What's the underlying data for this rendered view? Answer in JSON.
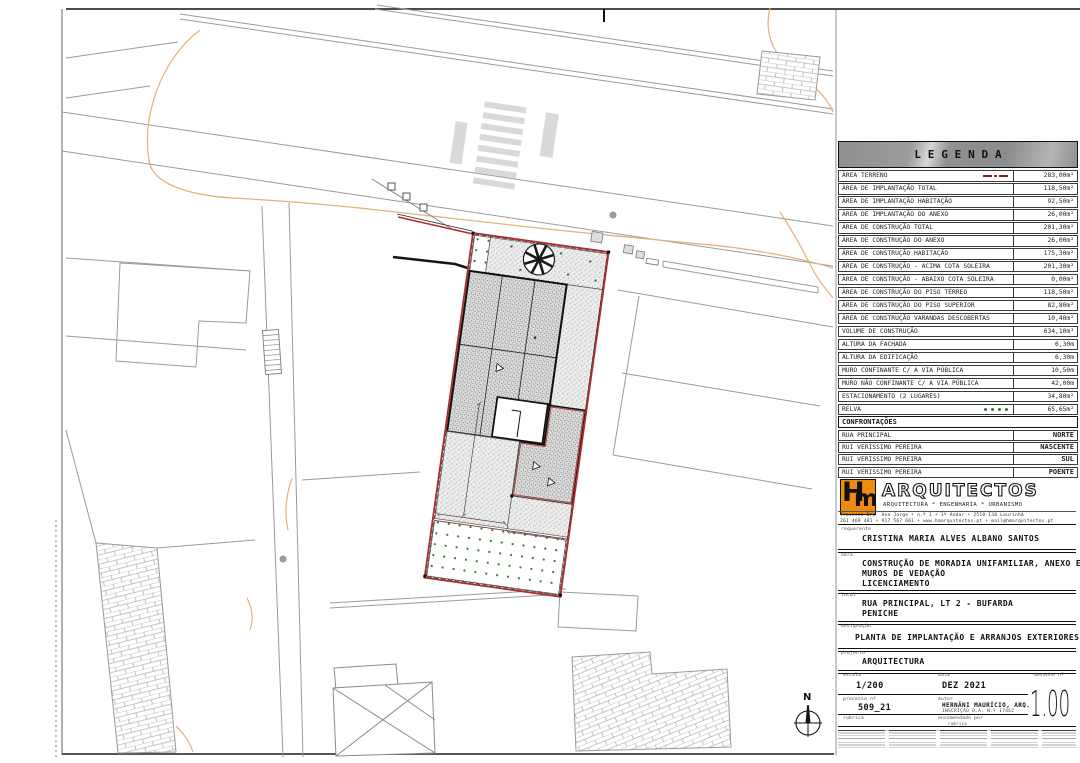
{
  "legend": {
    "title": "LEGENDA",
    "rows": [
      {
        "label": "ÁREA TERRENO",
        "value": "283,00m²",
        "symbol": "terrain"
      },
      {
        "label": "ÁREA DE IMPLANTAÇÃO TOTAL",
        "value": "118,50m²",
        "symbol": null
      },
      {
        "label": "ÁREA DE IMPLANTAÇÃO HABITAÇÃO",
        "value": "92,50m²",
        "symbol": null
      },
      {
        "label": "ÁREA DE IMPLANTAÇÃO DO ANEXO",
        "value": "26,00m²",
        "symbol": null
      },
      {
        "label": "ÁREA DE CONSTRUÇÃO TOTAL",
        "value": "201,30m²",
        "symbol": null
      },
      {
        "label": "ÁREA DE CONSTRUÇÃO DO ANEXO",
        "value": "26,00m²",
        "symbol": null
      },
      {
        "label": "ÁREA DE CONSTRUÇÃO HABITAÇÃO",
        "value": "175,30m²",
        "symbol": null
      },
      {
        "label": "ÁREA DE CONSTRUÇÃO - ACIMA COTA SOLEIRA",
        "value": "201,30m²",
        "symbol": null
      },
      {
        "label": "ÁREA DE CONSTRUÇÃO - ABAIXO COTA SOLEIRA",
        "value": "0,00m²",
        "symbol": null
      },
      {
        "label": "ÁREA DE CONSTRUÇÃO DO PISO TÉRREO",
        "value": "118,50m²",
        "symbol": null
      },
      {
        "label": "ÁREA DE CONSTRUÇÃO DO PISO SUPERIOR",
        "value": "82,80m²",
        "symbol": null
      },
      {
        "label": "ÁREA DE CONSTRUÇÃO VARANDAS DESCOBERTAS",
        "value": "10,40m²",
        "symbol": null
      },
      {
        "label": "VOLUME DE CONSTRUÇÃO",
        "value": "634,10m³",
        "symbol": null
      },
      {
        "label": "ALTURA DA FACHADA",
        "value": "6,30m",
        "symbol": null
      },
      {
        "label": "ALTURA DA EDIFICAÇÃO",
        "value": "6,30m",
        "symbol": null
      },
      {
        "label": "MURO CONFINANTE C/ A VIA PÚBLICA",
        "value": "10,50m",
        "symbol": null
      },
      {
        "label": "MURO NÃO CONFINANTE C/ A VIA PÚBLICA",
        "value": "42,00m",
        "symbol": null
      },
      {
        "label": "ESTACIONAMENTO (2 LUGARES)",
        "value": "34,80m²",
        "symbol": null
      },
      {
        "label": "RELVA",
        "value": "65,65m²",
        "symbol": "grass"
      },
      {
        "label": "PAVÊ",
        "value": "96,60m²",
        "symbol": "pave"
      }
    ]
  },
  "confrontacoes": {
    "title": "CONFRONTAÇÕES",
    "rows": [
      {
        "name": "RUA PRINCIPAL",
        "side": "NORTE"
      },
      {
        "name": "RUI VERISSIMO PEREIRA",
        "side": "NASCENTE"
      },
      {
        "name": "RUI VERISSIMO PEREIRA",
        "side": "SUL"
      },
      {
        "name": "RUI VERISSIMO PEREIRA",
        "side": "POENTE"
      }
    ]
  },
  "firm": {
    "logo_h": "H",
    "logo_m": "m",
    "name": "ARQUITECTOS",
    "tagline": "ARQUITECTURA * ENGENHARIA * URBANISMO",
    "address_line1": "Travessa Dra. Ana Jorge + n.º 1 + 1º Andar + 2510-138 Lourinhã",
    "address_line2": "261 469 481 + 917 567 661 + www.hmarquitectos.pt + mail@hmarquitectos.pt"
  },
  "titleblock": {
    "requerente_label": "requerente",
    "requerente": "CRISTINA MARIA ALVES ALBANO SANTOS",
    "obra_label": "obra",
    "obra_line1": "CONSTRUÇÃO DE MORADIA UNIFAMILIAR, ANEXO E",
    "obra_line2": "MUROS DE VEDAÇÃO",
    "obra_line3": "LICENCIAMENTO",
    "local_label": "local",
    "local_line1": "RUA PRINCIPAL, LT 2 - BUFARDA",
    "local_line2": "PENICHE",
    "designacao_label": "designação",
    "designacao": "PLANTA DE IMPLANTAÇÃO E ARRANJOS EXTERIORES",
    "projecto_label": "projecto",
    "projecto": "ARQUITECTURA",
    "escala_label": "escala",
    "escala": "1/200",
    "data_label": "data",
    "data": "DEZ 2021",
    "desenho_label": "desenho nº",
    "desenho": "1.00",
    "processo_label": "processo nº",
    "processo": "509_21",
    "autor_label": "autor",
    "autor_line1": "HERNÂNI MAURÍCIO, ARQ.",
    "autor_line2": "INSCRIÇÃO O.A. N.º 17462",
    "rubrica_label": "rubrica",
    "encomendado_label": "encomendado por",
    "rubrica2_label": "rubrica"
  },
  "compass": {
    "north_label": "N"
  },
  "colors": {
    "plot_red": "#b02b2b",
    "legend_red": "#8b1d1d",
    "grass_green": "#2f7a2b",
    "logo_orange": "#ef8b10",
    "contour_orange": "#e3b077"
  }
}
